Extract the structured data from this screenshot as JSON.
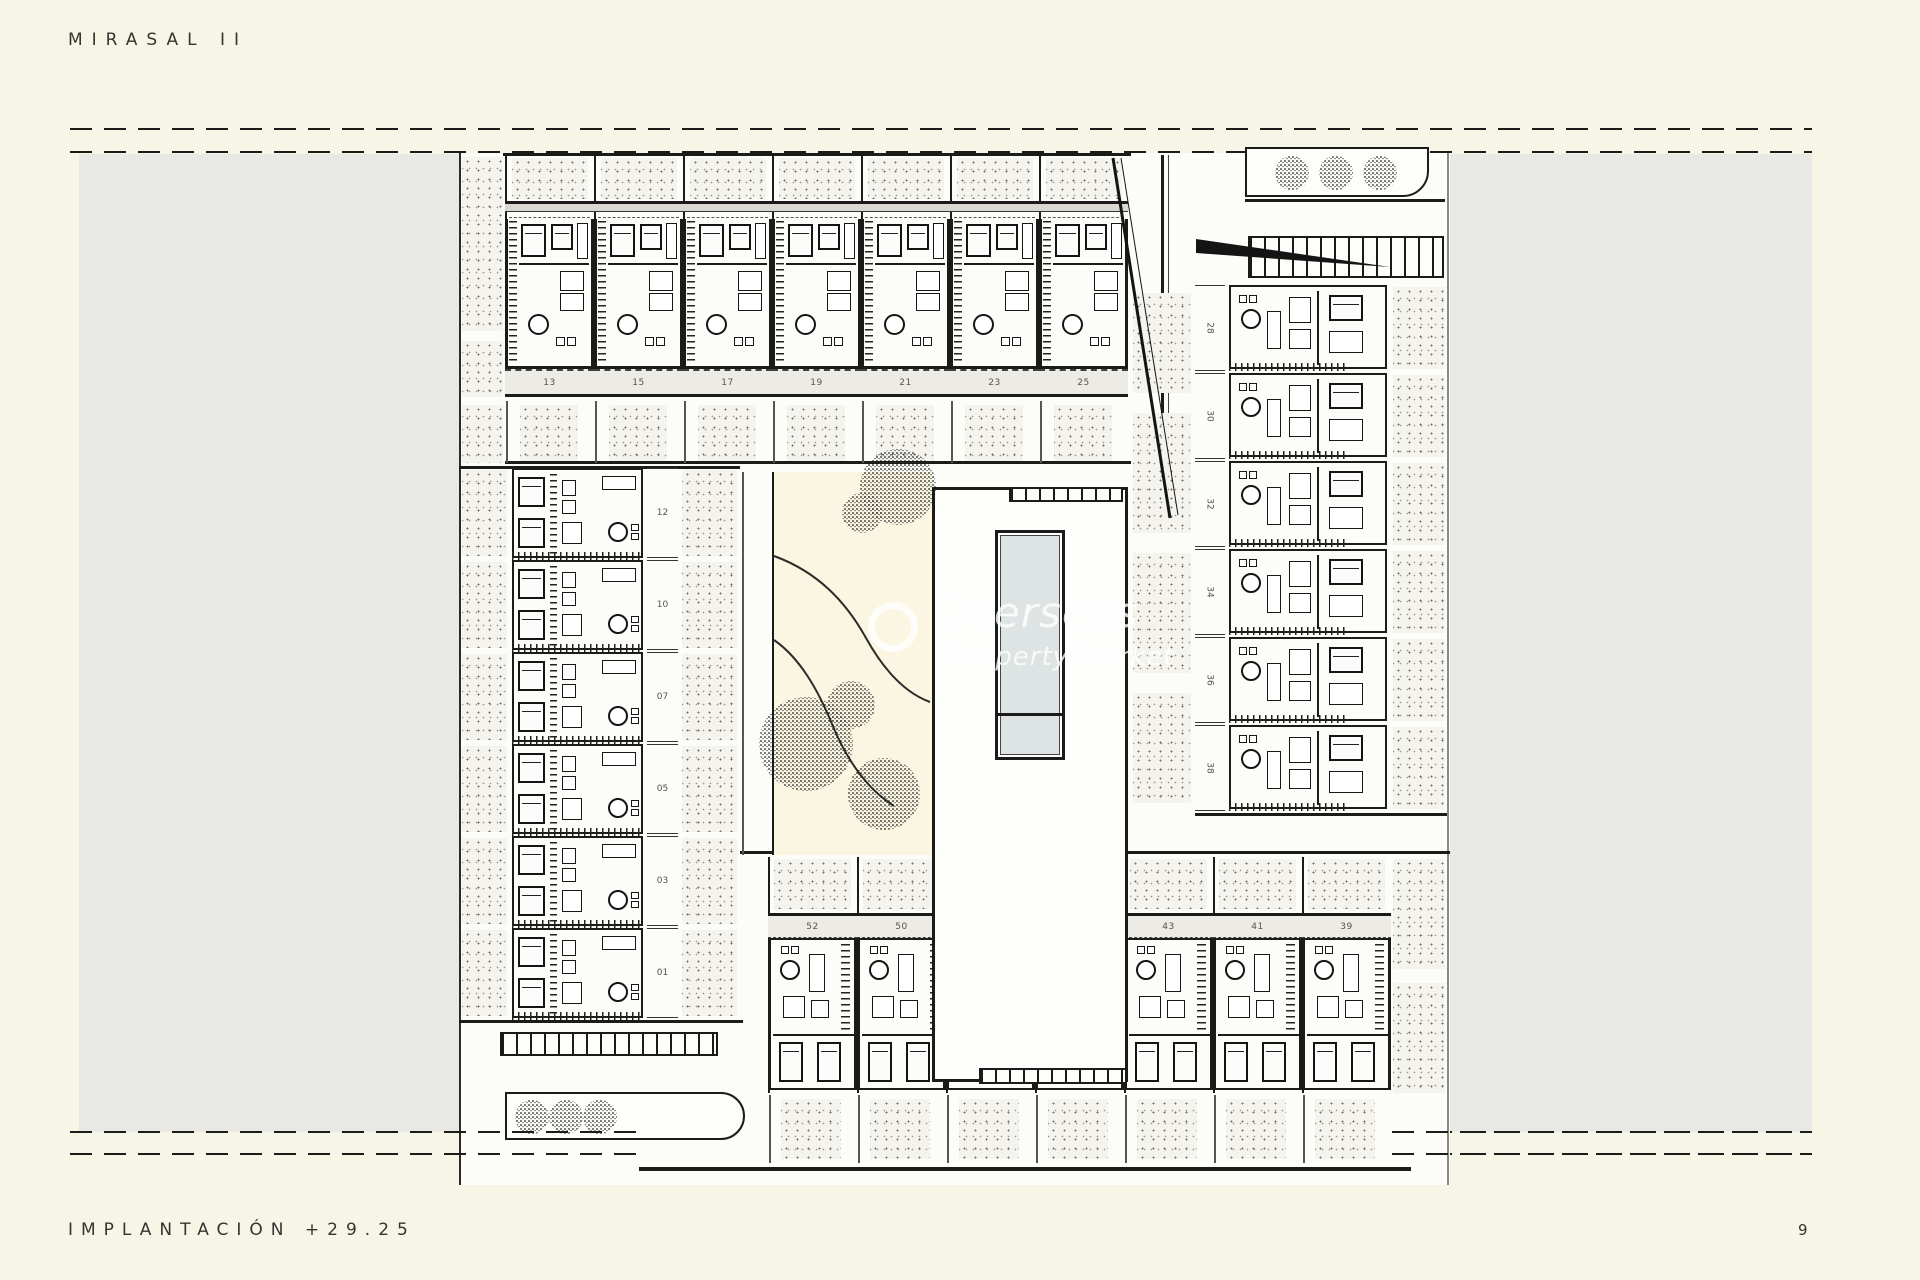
{
  "page": {
    "title": "MIRASAL II",
    "footer_label": "IMPLANTACIÓN +29.25",
    "page_number": "9"
  },
  "watermark": {
    "line1": "Overseas",
    "line2": "Property Market"
  },
  "plan": {
    "top_row_units": [
      "13",
      "15",
      "17",
      "19",
      "21",
      "23",
      "25"
    ],
    "left_column_units": [
      "12",
      "10",
      "07",
      "05",
      "03",
      "01"
    ],
    "right_column_units": [
      "28",
      "30",
      "32",
      "34",
      "36",
      "38"
    ],
    "bottom_row_units": [
      "52",
      "50",
      "47",
      "45",
      "43",
      "41",
      "39"
    ]
  },
  "colors": {
    "paper": "#f7f5e6",
    "panel_gray": "#e8e8e5",
    "plan_white": "#fcfcf9",
    "pool_water": "#dde4e3",
    "ink": "#1b1b1a",
    "label_band": "#edebe5",
    "garden_cream": "#faf6e2"
  }
}
